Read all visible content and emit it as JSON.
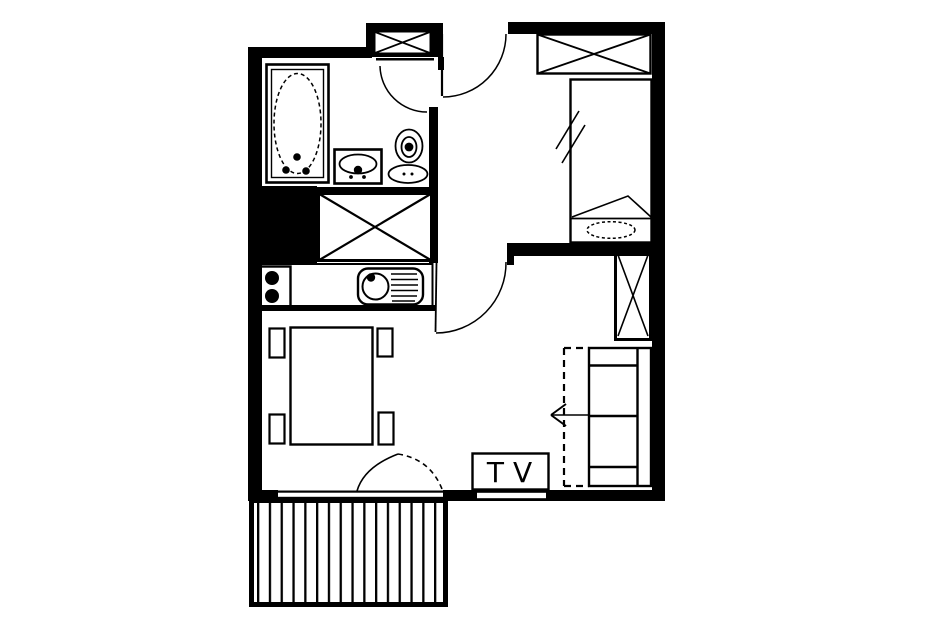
{
  "labels": {
    "tv": "TV"
  },
  "colors": {
    "line": "#000000",
    "background": "#ffffff"
  },
  "plan": {
    "type": "apartment-floor-plan",
    "fixture_icons": [
      "bathtub-icon",
      "washbasin-icon",
      "toilet-icon",
      "ventilation-shaft-icon",
      "entry-door-icon",
      "bathroom-door-icon",
      "bedroom-door-icon",
      "balcony-door-icon",
      "single-bed-icon",
      "pillow-icon",
      "headboard-cabinet-icon",
      "hall-closet-icon",
      "stove-burners-icon",
      "kitchen-sink-icon",
      "dining-table-icon",
      "chair-icon",
      "wardrobe-icon",
      "sofa-bed-icon",
      "pullout-arrow-icon",
      "tv-stand-icon",
      "window-icon",
      "balcony-hatch-icon"
    ]
  }
}
